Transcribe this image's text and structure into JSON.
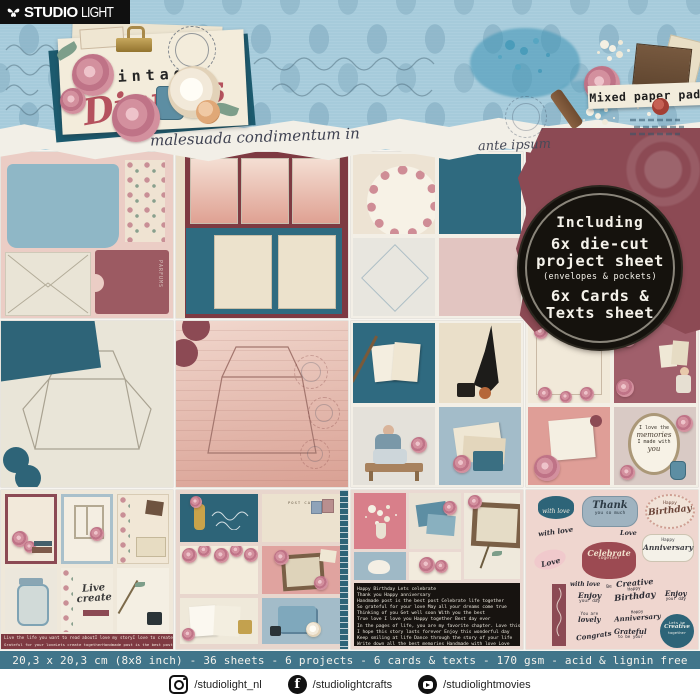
{
  "brand": {
    "studio": "STUDIO",
    "light": "LIGHT"
  },
  "header": {
    "title_top": "Vintage",
    "title_script": "Diaries",
    "tag": "Mixed paper pad",
    "handwriting_left": "malesuada condimentum in",
    "handwriting_right": "ante ipsum"
  },
  "badge": {
    "line1": "Including",
    "line2": "6x die-cut",
    "line3": "project sheet",
    "line4": "(envelopes & pockets)",
    "line5": "6x Cards &",
    "line6": "Texts sheet"
  },
  "specbar": {
    "text": "20,3 x 20,3 cm (8x8 inch) - 36 sheets - 6 projects - 6 cards & texts - 170 gsm - acid & lignin free"
  },
  "footer": {
    "instagram": "/studiolight_nl",
    "facebook": "/studiolightcrafts",
    "youtube": "/studiolightmovies"
  },
  "tiles": {
    "parfums": "PARFUMS",
    "postcard": "POST CARD",
    "memories": {
      "l1": "I love the",
      "l2": "memories",
      "l3": "I made with",
      "l4": "you"
    },
    "live_create": {
      "l1": "Live",
      "l2": "create"
    },
    "strip": {
      "r1a": "Live the life you want to read about",
      "r1b": "I love my story",
      "r1c": "I love to create",
      "r2a": "Grateful for your love",
      "r2b": "Lets create together",
      "r2c": "Handmade post is the best post"
    },
    "word_lines": [
      "Happy Birthday    Lets celebrate",
      "Thank you     Happy anniversary",
      "Handmade post is the best post   Celebrate life together",
      "So grateful for your love   May all your dreams come true",
      "Thinking of you    Get well soon    With you the best",
      "True love   I love you   Happy together   Best day ever",
      "In the pages of life, you are my favorite chapter. Love this",
      "I hope this story lasts forever  Enjoy this wonderful day",
      "Keep smiling at life  Dance through the story of your life",
      "Write down all the best memories  Handmade with love  Love"
    ],
    "sent": {
      "with_love": "with love",
      "thank": "Thank",
      "you_so_much": "you so much",
      "happy": "Happy",
      "birthday": "Birthday",
      "anniversary": "Anniversary",
      "love": "Love",
      "celebrate": "Celebrate",
      "together": "together",
      "be": "Be",
      "creative": "Creative",
      "enjoy": "Enjoy",
      "your_day": "your day",
      "you_are": "You are",
      "lovely": "lovely",
      "congrats": "Congrats",
      "grateful": "Grateful",
      "to_be_your": "to be your",
      "lets_be": "Lets be"
    }
  },
  "colors": {
    "banner_blue": "#a6cbdb",
    "splatter_teal": "#4a9cba",
    "teal_panel": "#2e6b80",
    "dark_red": "#7e3a42",
    "torn_red": "#8c4a54",
    "badge_black": "#15120d",
    "spec_teal": "#41758a",
    "cream": "#f3ecdb",
    "rose_pink": "#d3909e",
    "script_red": "#b5525e"
  }
}
